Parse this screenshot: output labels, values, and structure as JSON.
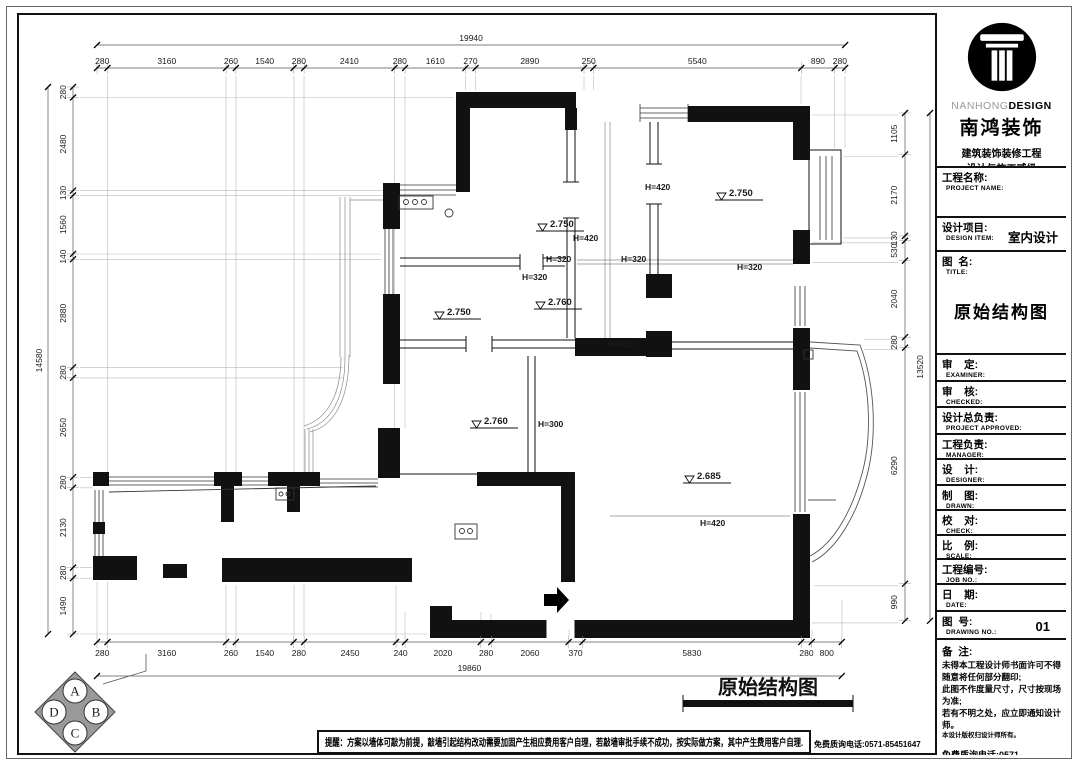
{
  "title_block": {
    "brand": {
      "latin_light": "NANHONG",
      "latin_bold": "DESIGN",
      "cn_name": "南鸿装饰",
      "line1": "建筑装饰装修工程",
      "line2": "设计与施工贰级",
      "cert": "编NO：X233021396"
    },
    "project_name_label": "工程名称:",
    "project_name_sub": "PROJECT NAME:",
    "design_item_label": "设计项目:",
    "design_item_sub": "DESIGN ITEM:",
    "design_item_value": "室内设计",
    "drawing_title_label": "图  名:",
    "drawing_title_sub": "TITLE:",
    "drawing_title_value": "原始结构图",
    "rows": [
      {
        "label": "审    定:",
        "sub": "EXAMINER:"
      },
      {
        "label": "审    核:",
        "sub": "CHECKED:"
      },
      {
        "label": "设计总负责:",
        "sub": "PROJECT APPROVED:"
      },
      {
        "label": "工程负责:",
        "sub": "MANAGER:"
      },
      {
        "label": "设    计:",
        "sub": "DESIGNER:"
      },
      {
        "label": "制    图:",
        "sub": "DRAWN:"
      },
      {
        "label": "校    对:",
        "sub": "CHECK:"
      },
      {
        "label": "比    例:",
        "sub": "SCALE:"
      },
      {
        "label": "工程编号:",
        "sub": "JOB  NO.:"
      },
      {
        "label": "日    期:",
        "sub": "DATE:"
      }
    ],
    "drawing_no_label": "图  号:",
    "drawing_no_sub": "DRAWING NO.:",
    "drawing_no_value": "01",
    "notes_label": "备  注:",
    "notes": [
      "未得本工程设计师书面许可不得随意将任何部分翻印;",
      "此图不作度量尺寸，尺寸按现场为准;",
      "若有不明之处，应立即通知设计师。",
      "本设计版权归设计师所有。"
    ],
    "hotline": "免费质询电话:0571-85451647"
  },
  "plan": {
    "caption": "原始结构图",
    "levels": [
      {
        "v": "2.750",
        "x": 552,
        "y": 226
      },
      {
        "v": "2.750",
        "x": 731,
        "y": 195
      },
      {
        "v": "2.750",
        "x": 449,
        "y": 314
      },
      {
        "v": "2.760",
        "x": 550,
        "y": 304
      },
      {
        "v": "2.760",
        "x": 486,
        "y": 423
      },
      {
        "v": "2.685",
        "x": 699,
        "y": 478
      }
    ],
    "heights": [
      {
        "v": "H=420",
        "x": 573,
        "y": 241
      },
      {
        "v": "H=420",
        "x": 645,
        "y": 190
      },
      {
        "v": "H=420",
        "x": 608,
        "y": 347
      },
      {
        "v": "H=420",
        "x": 700,
        "y": 526
      },
      {
        "v": "H=320",
        "x": 546,
        "y": 262
      },
      {
        "v": "H=320",
        "x": 621,
        "y": 262
      },
      {
        "v": "H=320",
        "x": 737,
        "y": 270
      },
      {
        "v": "H=320",
        "x": 522,
        "y": 280
      },
      {
        "v": "H=300",
        "x": 538,
        "y": 427
      }
    ],
    "dims": {
      "top": {
        "total": "19940",
        "segments": [
          280,
          3160,
          260,
          1540,
          280,
          2410,
          280,
          1610,
          270,
          2890,
          250,
          5540,
          890,
          280
        ]
      },
      "bottom": {
        "total": "19860",
        "segments": [
          280,
          3160,
          260,
          1540,
          280,
          2450,
          240,
          2020,
          280,
          2060,
          370,
          5830,
          280,
          800
        ]
      },
      "left": {
        "total": "14580",
        "segments": [
          280,
          2480,
          130,
          1560,
          140,
          2880,
          280,
          2650,
          280,
          2130,
          280,
          1490
        ]
      },
      "right": {
        "total": "13520",
        "segments": [
          1105,
          2170,
          130,
          530,
          2040,
          280,
          6290,
          990
        ]
      }
    }
  },
  "footer": {
    "reminder": "提醒：方案以墙体可敲为前提，敲墙引起结构改动需要加固产生相应费用客户自理，若敲墙审批手续不成功，按实际做方案，其中产生费用客户自理.",
    "hotline": "免费质询电话:0571-85451647"
  },
  "compass": {
    "letters": [
      "A",
      "B",
      "C",
      "D"
    ]
  }
}
